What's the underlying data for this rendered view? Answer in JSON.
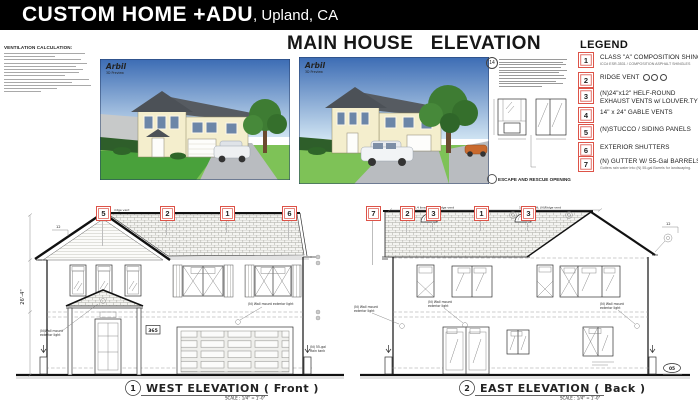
{
  "header": {
    "title": "CUSTOM HOME +ADU",
    "location": ", Upland, CA"
  },
  "sheet": {
    "title": "MAIN HOUSE   ELEVATION"
  },
  "vent_calc": {
    "heading": "VENTILATION CALCULATION:"
  },
  "renders": {
    "watermark": "Arbil",
    "watermark_sub": "3D Preview"
  },
  "note14": {
    "ref": "14",
    "caption": "ESCAPE AND RESCUE OPENING"
  },
  "legend": {
    "title": "LEGEND",
    "items": [
      {
        "num": "1",
        "label": "CLASS \"A\" COMPOSITION SHINGLES",
        "sub": "ICC# ESR-3531 / COMPOSITION ASPHALT SHINGLES"
      },
      {
        "num": "2",
        "label": "RIDGE VENT"
      },
      {
        "num": "3",
        "label": "(N)24\"x12\" HELF-ROUND",
        "label2": "EXHAUST VENTS w/ LOUVER.TYP"
      },
      {
        "num": "4",
        "label": "14\" x 24\" GABLE VENTS"
      },
      {
        "num": "5",
        "label": "(N)STUCCO / SIDING PANELS"
      },
      {
        "num": "6",
        "label": "EXTERIOR SHUTTERS"
      },
      {
        "num": "7",
        "label": "(N) GUTTER W/ 55-Gal BARRELS",
        "sub": "Gutters rain water into (N) 55-gal Barrels for landscaping."
      }
    ]
  },
  "callouts": {
    "west": [
      "5",
      "2",
      "1",
      "6"
    ],
    "east": [
      "7",
      "2",
      "3",
      "1",
      "3"
    ]
  },
  "west": {
    "num": "1",
    "title": "WEST  ELEVATION ( Front )",
    "scale": "SCALE : 1/4\" = 1'-0\"",
    "dim_height": "26'-4\"",
    "pitch": "12",
    "ridge_note": "ridge vent",
    "plaque": "365",
    "light1_l1": "(N)Wall mount",
    "light1_l2": "exterior light",
    "light2": "(N) Wall mount exterior light",
    "rain_l1": "(N) 55-gal",
    "rain_l2": "Rain tank"
  },
  "east": {
    "num": "2",
    "title": "EAST  ELEVATION ( Back )",
    "scale": "SCALE : 1/4\" = 1'-0\"",
    "dim_left": "6.4 linear ft. (N)Ridge vent",
    "dim_right": "16.4 linear ft. (N)Ridge vent",
    "pitch": "12",
    "light_l1": "(N) Wall mount",
    "light_l2": "exterior light",
    "detail_ref": "05"
  },
  "colors": {
    "header_bg": "#000000",
    "callout_red": "#dd5348"
  }
}
